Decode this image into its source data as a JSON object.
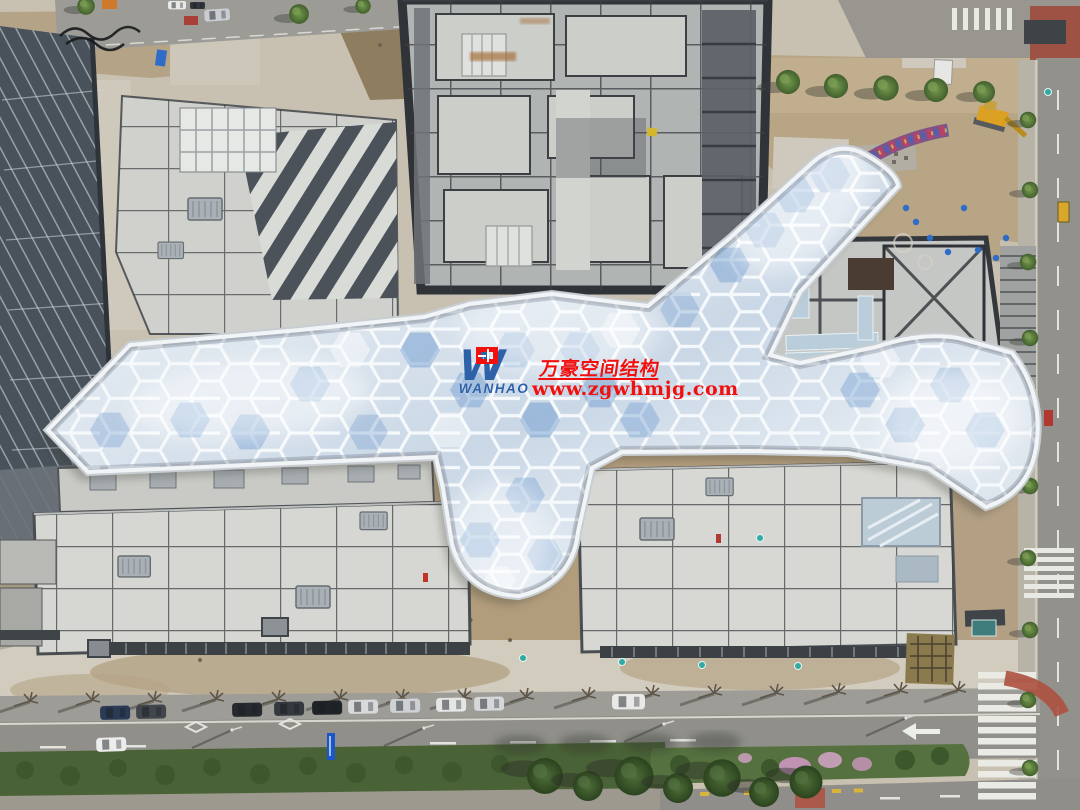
{
  "image": {
    "type": "aerial-photograph",
    "subject": "Top-down drone view of a construction site: a branching hexagonal ETFE membrane canopy links concrete building roofs; a high-rise core under construction at top, roads with parked cars, trees and a landscaped median at bottom, intersection with crosswalks at right."
  },
  "watermark": {
    "logo_monogram": "W",
    "logo_text": "WANHAO",
    "company_name_cn": "万豪空间结构",
    "website": "www.zgwhmjg.com"
  },
  "colors": {
    "watermark_red": "#f2100e",
    "logo_blue": "#2e62a8",
    "canopy_silver": "#dce5ee",
    "canopy_blue_reflection": "#6f9ccf",
    "concrete_roof": "#d6d7d2",
    "dirt_tan": "#b3a084",
    "asphalt_gray": "#8f8e8a",
    "tree_green": "#4a6336",
    "blossom_pink": "#cc97bf",
    "machine_yellow": "#dca122",
    "red_lane": "#ad5140"
  }
}
